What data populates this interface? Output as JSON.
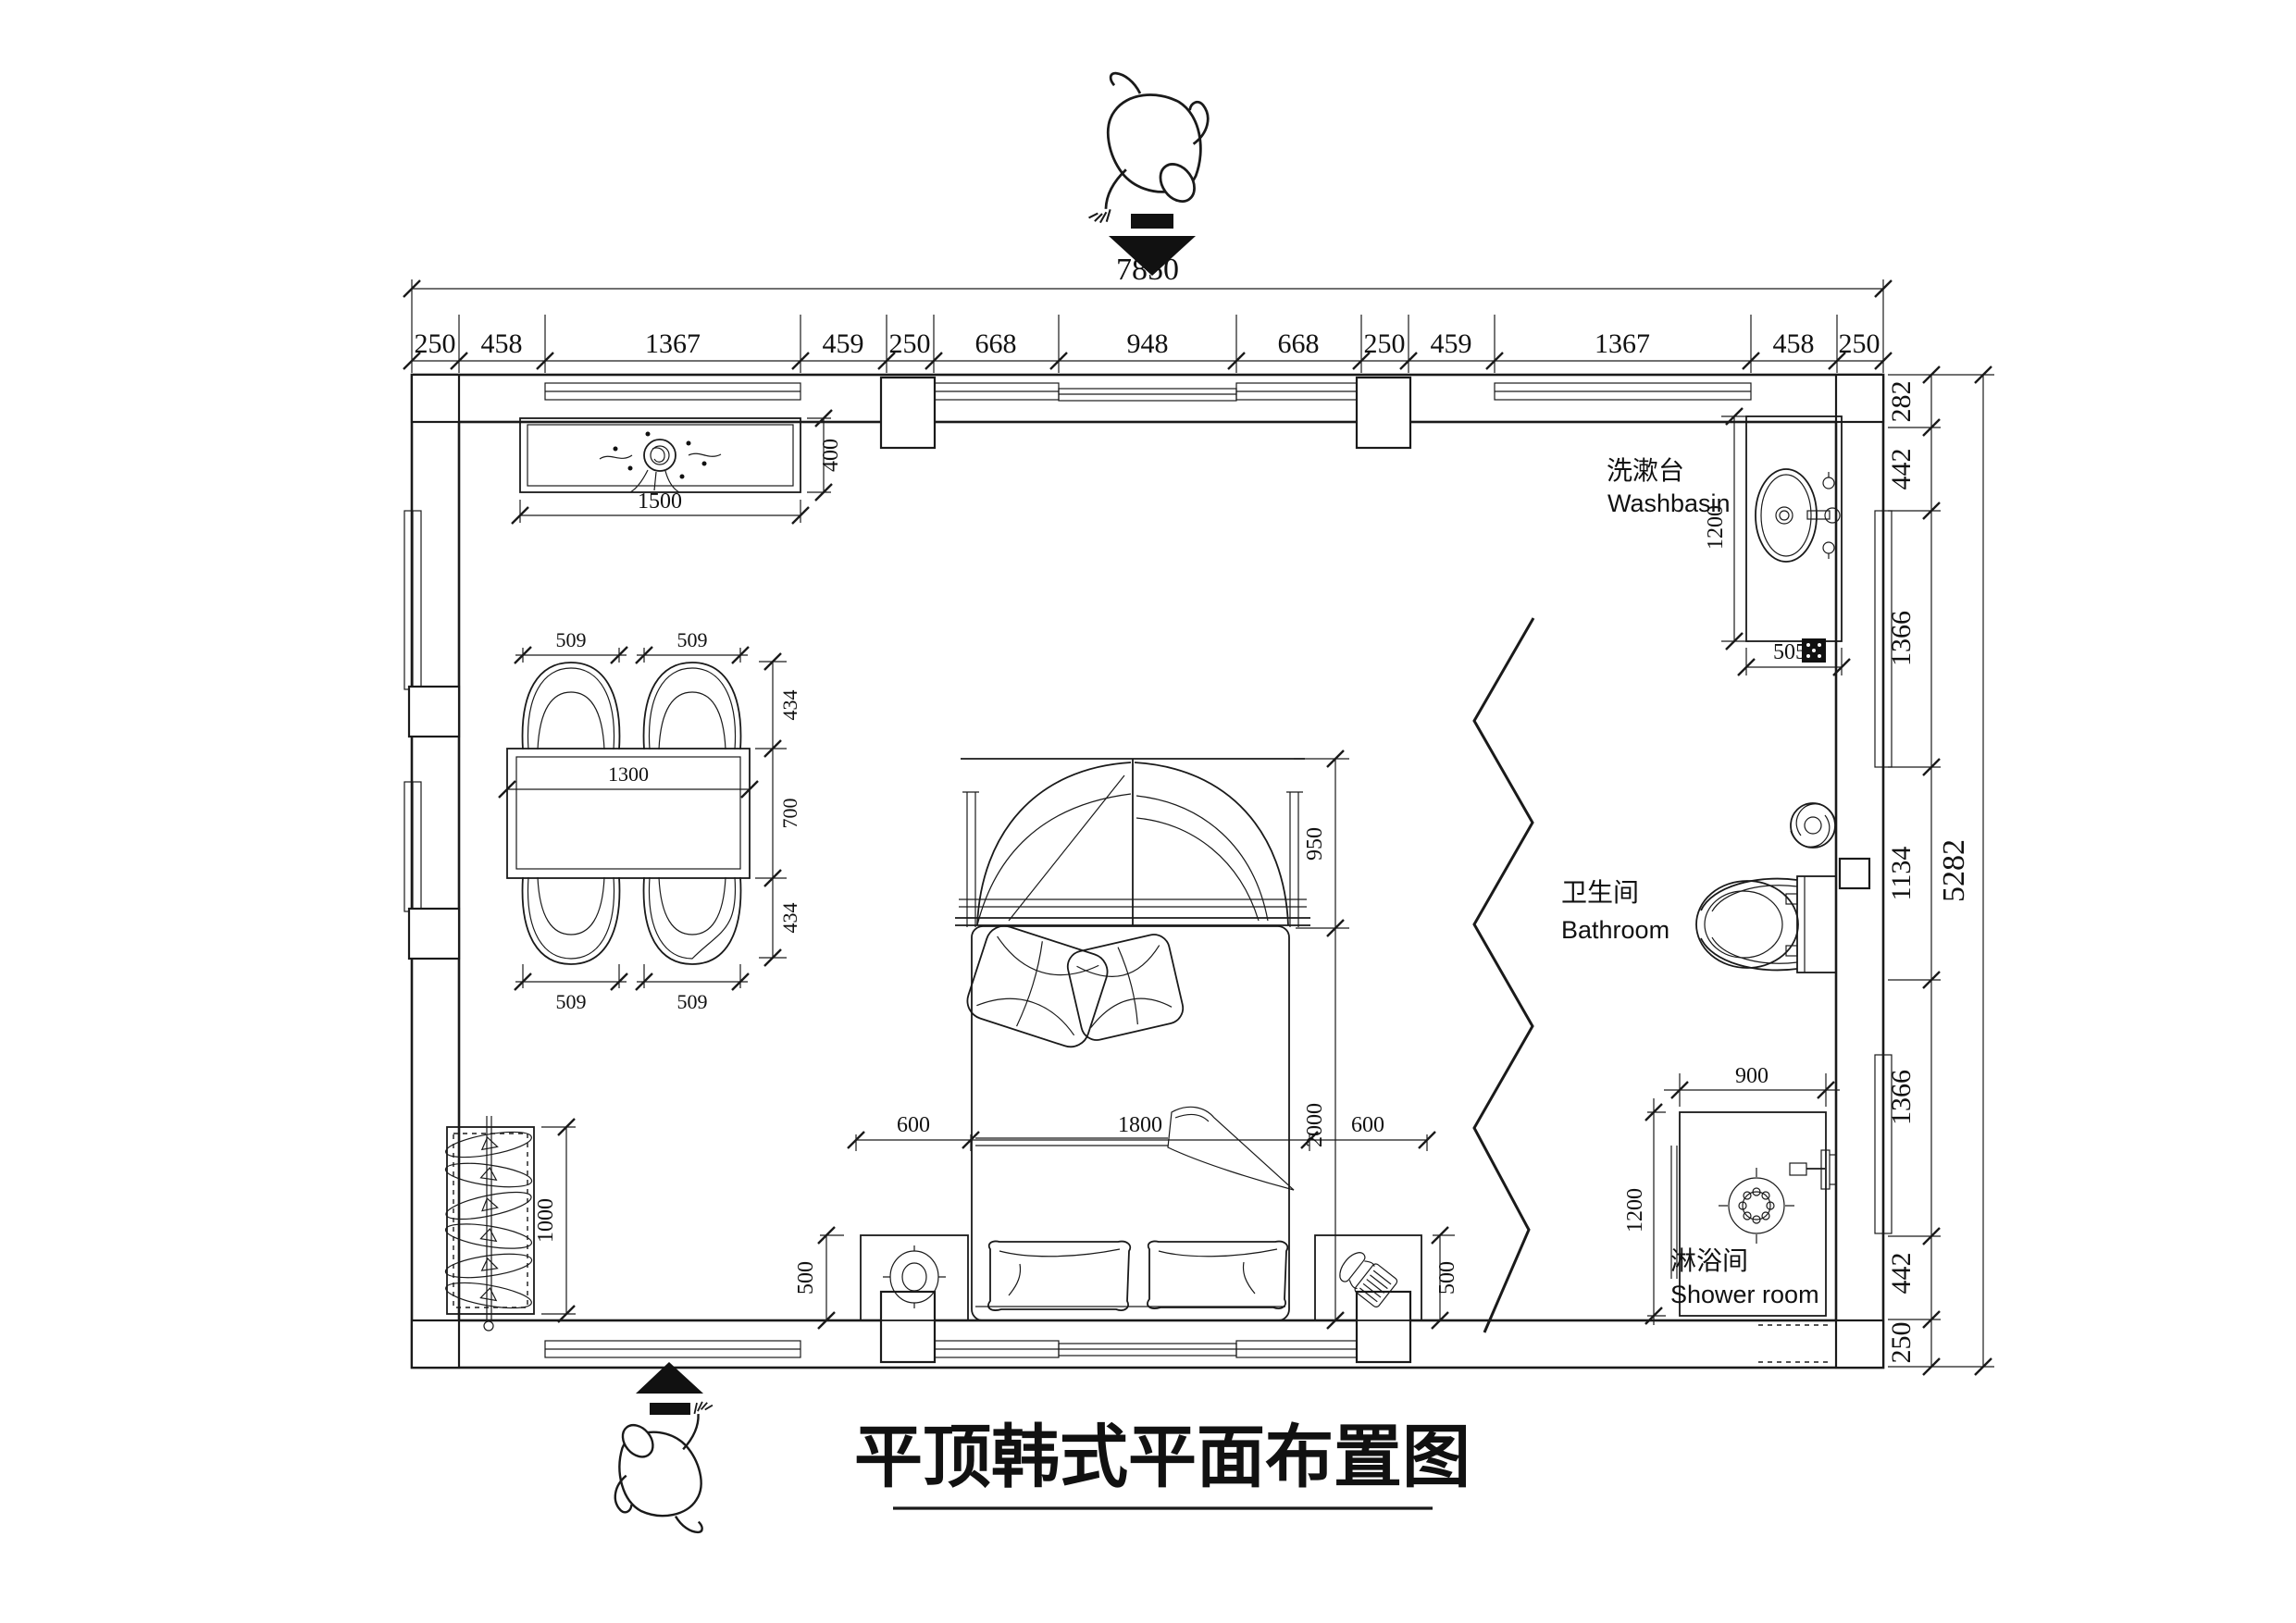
{
  "title": {
    "text": "平顶韩式平面布置图"
  },
  "chains": {
    "top_total": "7850",
    "top": [
      "250",
      "458",
      "1367",
      "459",
      "250",
      "668",
      "948",
      "668",
      "250",
      "459",
      "1367",
      "458",
      "250"
    ],
    "right_total": "5282",
    "right": [
      "282",
      "442",
      "1366",
      "1134",
      "1366",
      "442",
      "250"
    ]
  },
  "rooms": {
    "washbasin": {
      "zh": "洗漱台",
      "en": "Washbasin"
    },
    "bathroom": {
      "zh": "卫生间",
      "en": "Bathroom"
    },
    "shower": {
      "zh": "淋浴间",
      "en": "Shower room"
    }
  },
  "dims": {
    "cabinet_width": "1500",
    "cabinet_depth": "400",
    "dining": {
      "top_left": "509",
      "top_right": "509",
      "bottom_left": "509",
      "bottom_right": "509",
      "side_top": "434",
      "side_mid": "700",
      "side_bottom": "434",
      "table": "1300"
    },
    "wardrobe": "1000",
    "bed": {
      "canopy": "950",
      "length": "2000",
      "left": "600",
      "width": "1800",
      "right": "600",
      "ns_left": "500",
      "ns_right": "500"
    },
    "vanity": {
      "depth": "1200",
      "drain": "505"
    },
    "shower": {
      "width": "900",
      "depth": "1200"
    }
  },
  "colors": {
    "line": "#1a1a1a",
    "background": "#ffffff"
  }
}
